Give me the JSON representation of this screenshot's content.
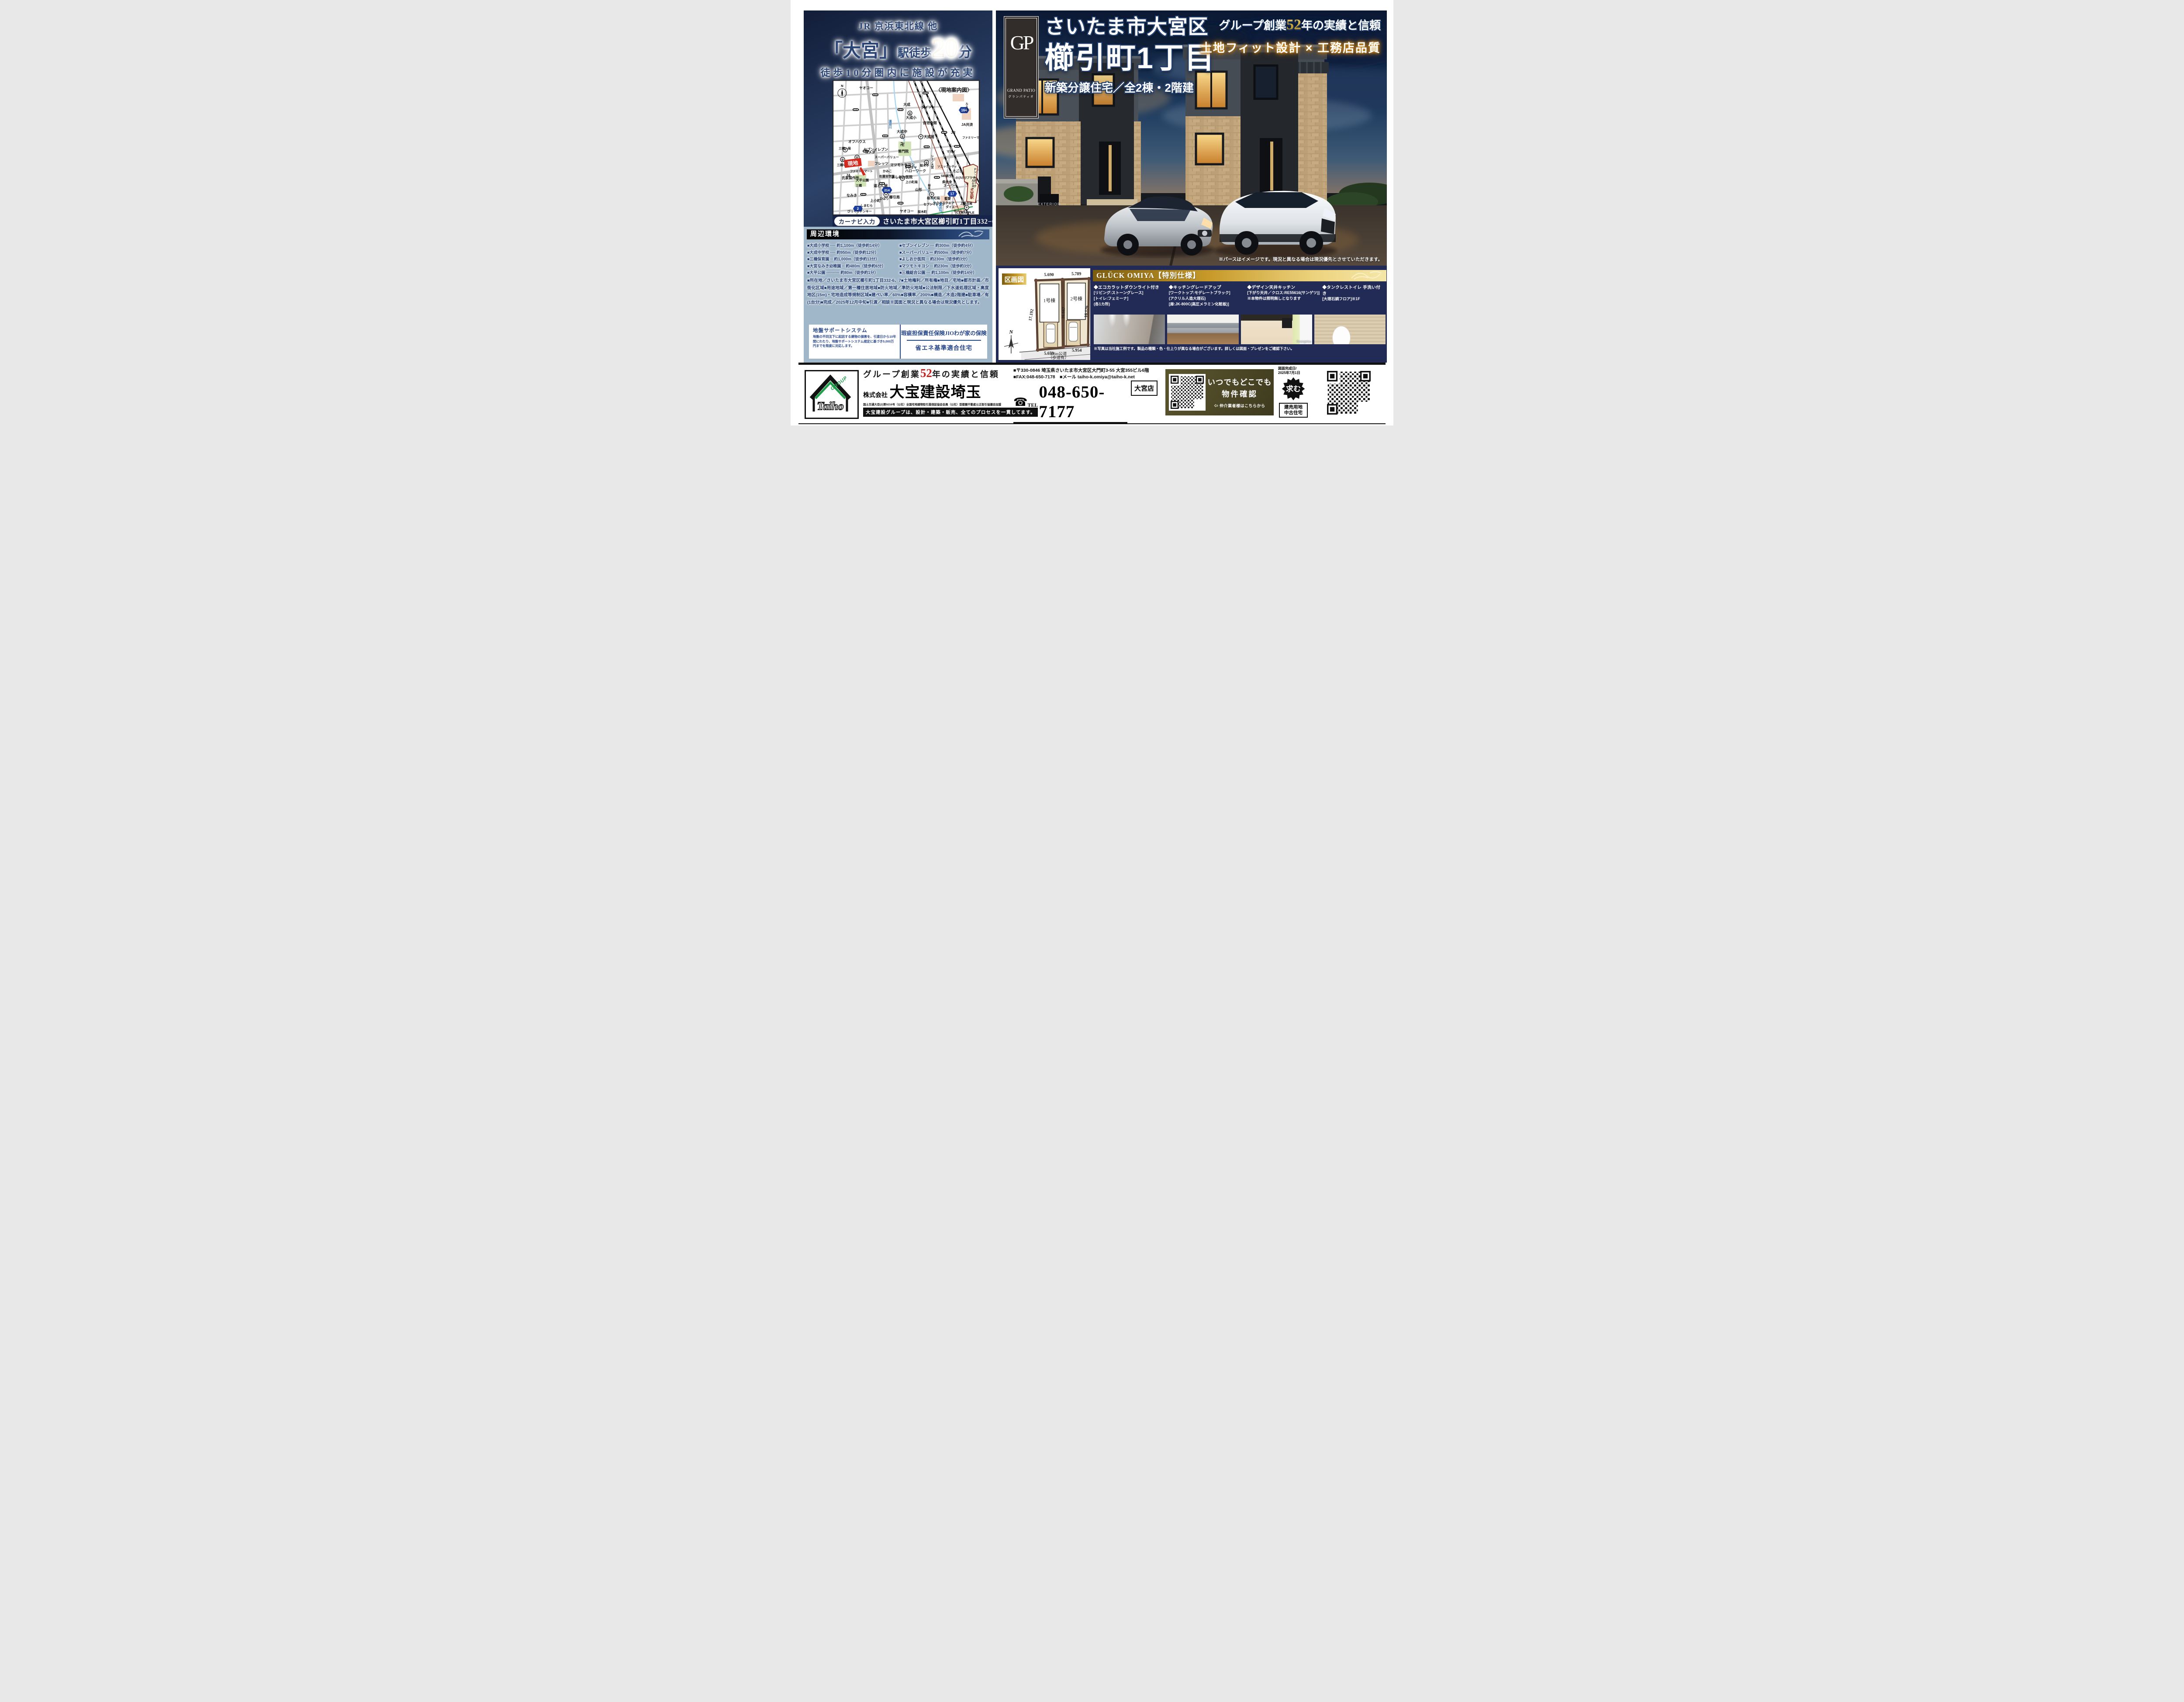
{
  "header_left": {
    "line1": "JR 京浜東北線 他",
    "station": "「大宮」",
    "suffix": "駅徒歩",
    "minutes": "20",
    "minutes_unit": "分",
    "sub": "徒歩10分圏内に施設が充実"
  },
  "map": {
    "title": "〈現地案内図〉",
    "compass_n": "N",
    "site_marker": "現地",
    "credit": "(C) MAPPLE",
    "navi_label": "カーナビ入力",
    "navi_address": "さいたま市大宮区櫛引町1丁目332−6",
    "badges": [
      "164",
      "2",
      "214",
      "17"
    ],
    "icons": {
      "school": "文",
      "post": "〒",
      "temple": "卍",
      "kinder": "幼",
      "nursery": "育",
      "cross": "＋"
    },
    "labels": [
      "ヤオコー",
      "〈現地案内図〉",
      "大成",
      "ダイソー",
      "大成小",
      "自治会館",
      "大成中",
      "大成局",
      "普門院",
      "オフハウス",
      "セブンイレブン",
      "フレッツ",
      "マツモトキヨシ",
      "ハローワーク",
      "よしおか医院",
      "氏家製作所",
      "大平公園",
      "道とん堀",
      "なみき",
      "上小町",
      "櫛引局",
      "山形",
      "桜木町局",
      "聖愛",
      "サクラスクエア",
      "ダイエー",
      "県信金",
      "JR",
      "JA共済",
      "ファミリーマート",
      "ドン・キホーテ",
      "ルミネ1",
      "大宮駅",
      "三橋一局",
      "コメダ",
      "スーパーバリュー",
      "三橋中",
      "三橋小",
      "ファミリーマート",
      "JA",
      "かみこ",
      "佐藤栄学園",
      "三橋",
      "上小町局",
      "オカダヤ",
      "桜木中",
      "シーノ大宮",
      "ソニックシティ",
      "マルイ",
      "SBI新生",
      "そごう",
      "のびのびプラザ",
      "桜木小",
      "スーパー",
      "ひばり",
      "しまむら",
      "びっくりドンキー",
      "ヤオコー",
      "セブンイレブン",
      "上落合局",
      "ホームズ",
      "鴻沼川",
      "鴻沼川",
      "桜木町",
      "ルミネ2"
    ]
  },
  "surroundings": {
    "title": "周辺環境",
    "items_left": [
      "■大成小学校 ···· 約1,100m（徒歩約14分）",
      "■大成中学校 ···· 約950m（徒歩約12分）",
      "■三橋保育園 ·· 約1,000m（徒歩約13分）",
      "■大宮なみき幼稚園 ·· 約480m（徒歩約6分）",
      "■大平公園 ·········· 約80m（徒歩約1分）"
    ],
    "items_right": [
      "■セブンイレブン ··· 約300m（徒歩約4分）",
      "■スーパーバリュー 約500m（徒歩約7分）",
      "■よしおか医院 ·· 約230m（徒歩約3分）",
      "■マツモトキヨシ ·· 約230m（徒歩約3分）",
      "■三橋総合公園 ··· 約1,100m（徒歩約14分）"
    ]
  },
  "details": "■所在地／さいたま市大宮区櫛引町1丁目332-6、7■土地権利／所有権■地目／宅地■都市計画／市街化区域■用途地域／第一種住居地域■防火地域／準防火地域■公法制限／下水道処理区域・高度地区(15m)・宅地造成等規制区域■建ぺい率／60%■容積率／200%■構造／木造2階建■駐車場／有(1台分)■完成／2025年12月中旬■引渡／相談※図面と現況と異なる場合は現況優先とします。",
  "support_box": {
    "left_title": "地盤サポートシステム",
    "left_body": "地盤の不同沈下に起因する建物の損害を、引渡日から10年間にわたり、地盤サポートシステム規定に基づき5,000万円までを限度に対応します。",
    "right_top": "瑕疵担保責任保険JIOわが家の保険",
    "right_bottom": "省エネ基準適合住宅"
  },
  "hero": {
    "logo_monogram": "GP",
    "logo_name": "GRAND PATIO",
    "logo_kana": "グランパティオ",
    "title_line1": "さいたま市大宮区",
    "title_line2": "櫛引町1丁目",
    "title_line3": "新築分譲住宅／全2棟・2階建",
    "right_pre": "グループ創業",
    "right_num": "52",
    "right_post": "年の実績と信頼",
    "right_line2": "土地フィット設計 × 工務店品質",
    "gate_sign": "EXTERIOR",
    "disclaimer": "※パースはイメージです。現況と異なる場合は現況優先とさせていただきます。"
  },
  "plan": {
    "tag": "区画図",
    "lot1": "1号棟",
    "lot2": "2号棟",
    "dim_top1": "5.690",
    "dim_top2": "5.789",
    "dim_left": "17.192",
    "dim_mid": "16.667",
    "dim_right": "16.126",
    "dim_bot1": "5.659",
    "dim_bot2": "5.954",
    "road1": "9.8m公道",
    "road2": "（歩道有）",
    "compass_n": "N"
  },
  "specs": {
    "header": "GLÜCK OMIYA【特別仕様】",
    "columns": [
      {
        "title": "◆エコカラットダウンライト付き",
        "lines": [
          "[リビング:ストーングレース]",
          "[トイレ:フェミーナ]",
          "(各1カ所)"
        ]
      },
      {
        "title": "◆キッチングレードアップ",
        "lines": [
          "[ワークトップ:モデレートブラック]",
          "(アクリル人造大理石)",
          "[扉:JK-800C(高圧メラミン化粧板)]"
        ]
      },
      {
        "title": "◆デザイン天井キッチン",
        "lines": [
          "[下がり天井／クロス:RE55616(サンゲツ)]",
          "※本物件は照明無しとなります"
        ]
      },
      {
        "title": "◆タンクレストイレ 手洗い付き",
        "lines": [
          "[大理石調フロア]※1F"
        ]
      }
    ],
    "photo_credit": "©sangetsu",
    "note": "※写真は当社施工例です。製品の種類・色・仕上りが異なる場合がございます。詳しくは図面・プレゼンをご確認下さい。"
  },
  "footer": {
    "logo_text": "Taiho",
    "logo_group": "GROUP",
    "tagline_pre": "グループ創業",
    "tagline_num": "52",
    "tagline_post": "年の実績と信頼",
    "company_prefix": "株式会社",
    "company_name": "大宝建設埼玉",
    "license": "国土交通大臣(2)第9216号（公社）全国宅地建物取引業保証協会会員（公社）首都圏不動産公正取引協議会加盟",
    "slogan": "大宝建設グループは、設計・建築・販売、全てのプロセスを一貫してます。",
    "address": "■〒330-0846 埼玉県さいたま市大宮区大門町3-55 大宮355ビル6階",
    "fax_mail": "■FAX:048-650-7178　■メール taiho-k.omiya@taiho-k.net",
    "tel_label": "TEL",
    "tel_icon": "☎",
    "tel_number": "048-650-7177",
    "branch": "大宮店",
    "hours": "■定休日／毎週水曜日 第1、3木曜日 ■取引態様／売主 ■手数料／3%（税込）",
    "qr_line1": "いつでもどこでも",
    "qr_line2": "物件確認",
    "qr_sub": "⇦ 仲介業者様はこちらから",
    "date_label": "図面完成日/",
    "date_value": "2025年7月1日",
    "motomu": "求む",
    "motomu_line1": "建売用地",
    "motomu_line2": "中古住宅"
  }
}
